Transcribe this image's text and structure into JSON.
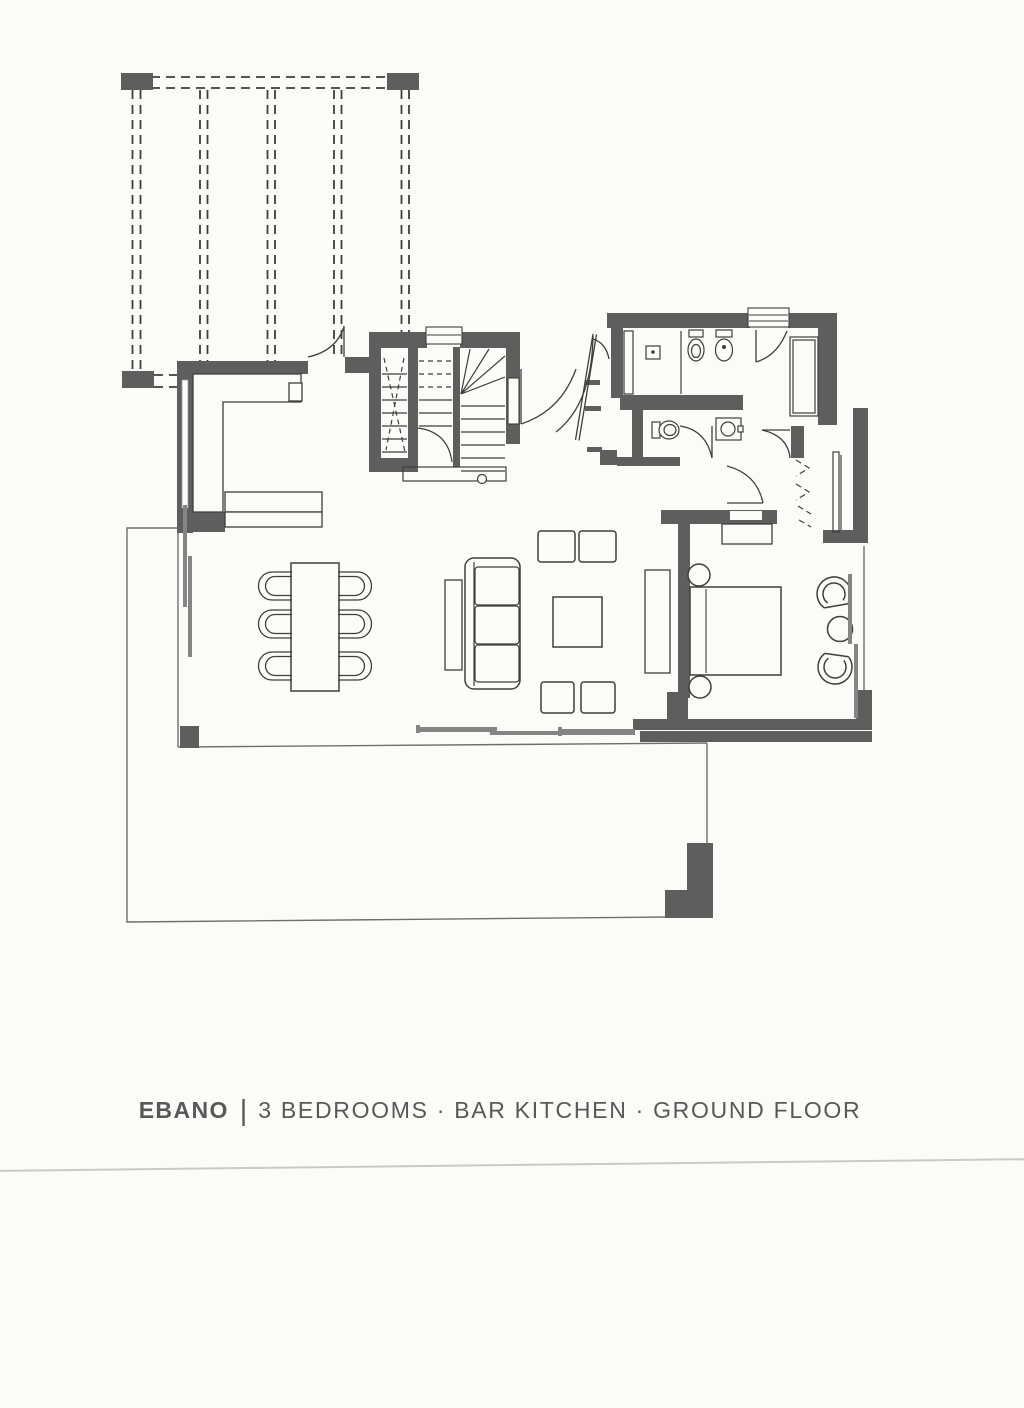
{
  "caption": {
    "project_name": "EBANO",
    "separator": "|",
    "description": "3 BEDROOMS · BAR KITCHEN · GROUND FLOOR"
  },
  "colors": {
    "paper": "#fbfbf8",
    "wall_fill": "#5e5e5e",
    "line_dark": "#3e3e3e",
    "line_medium": "#6e6e6e",
    "track_gray": "#858585",
    "scan_line": "#c9c9c6",
    "caption_text": "#58585a"
  }
}
